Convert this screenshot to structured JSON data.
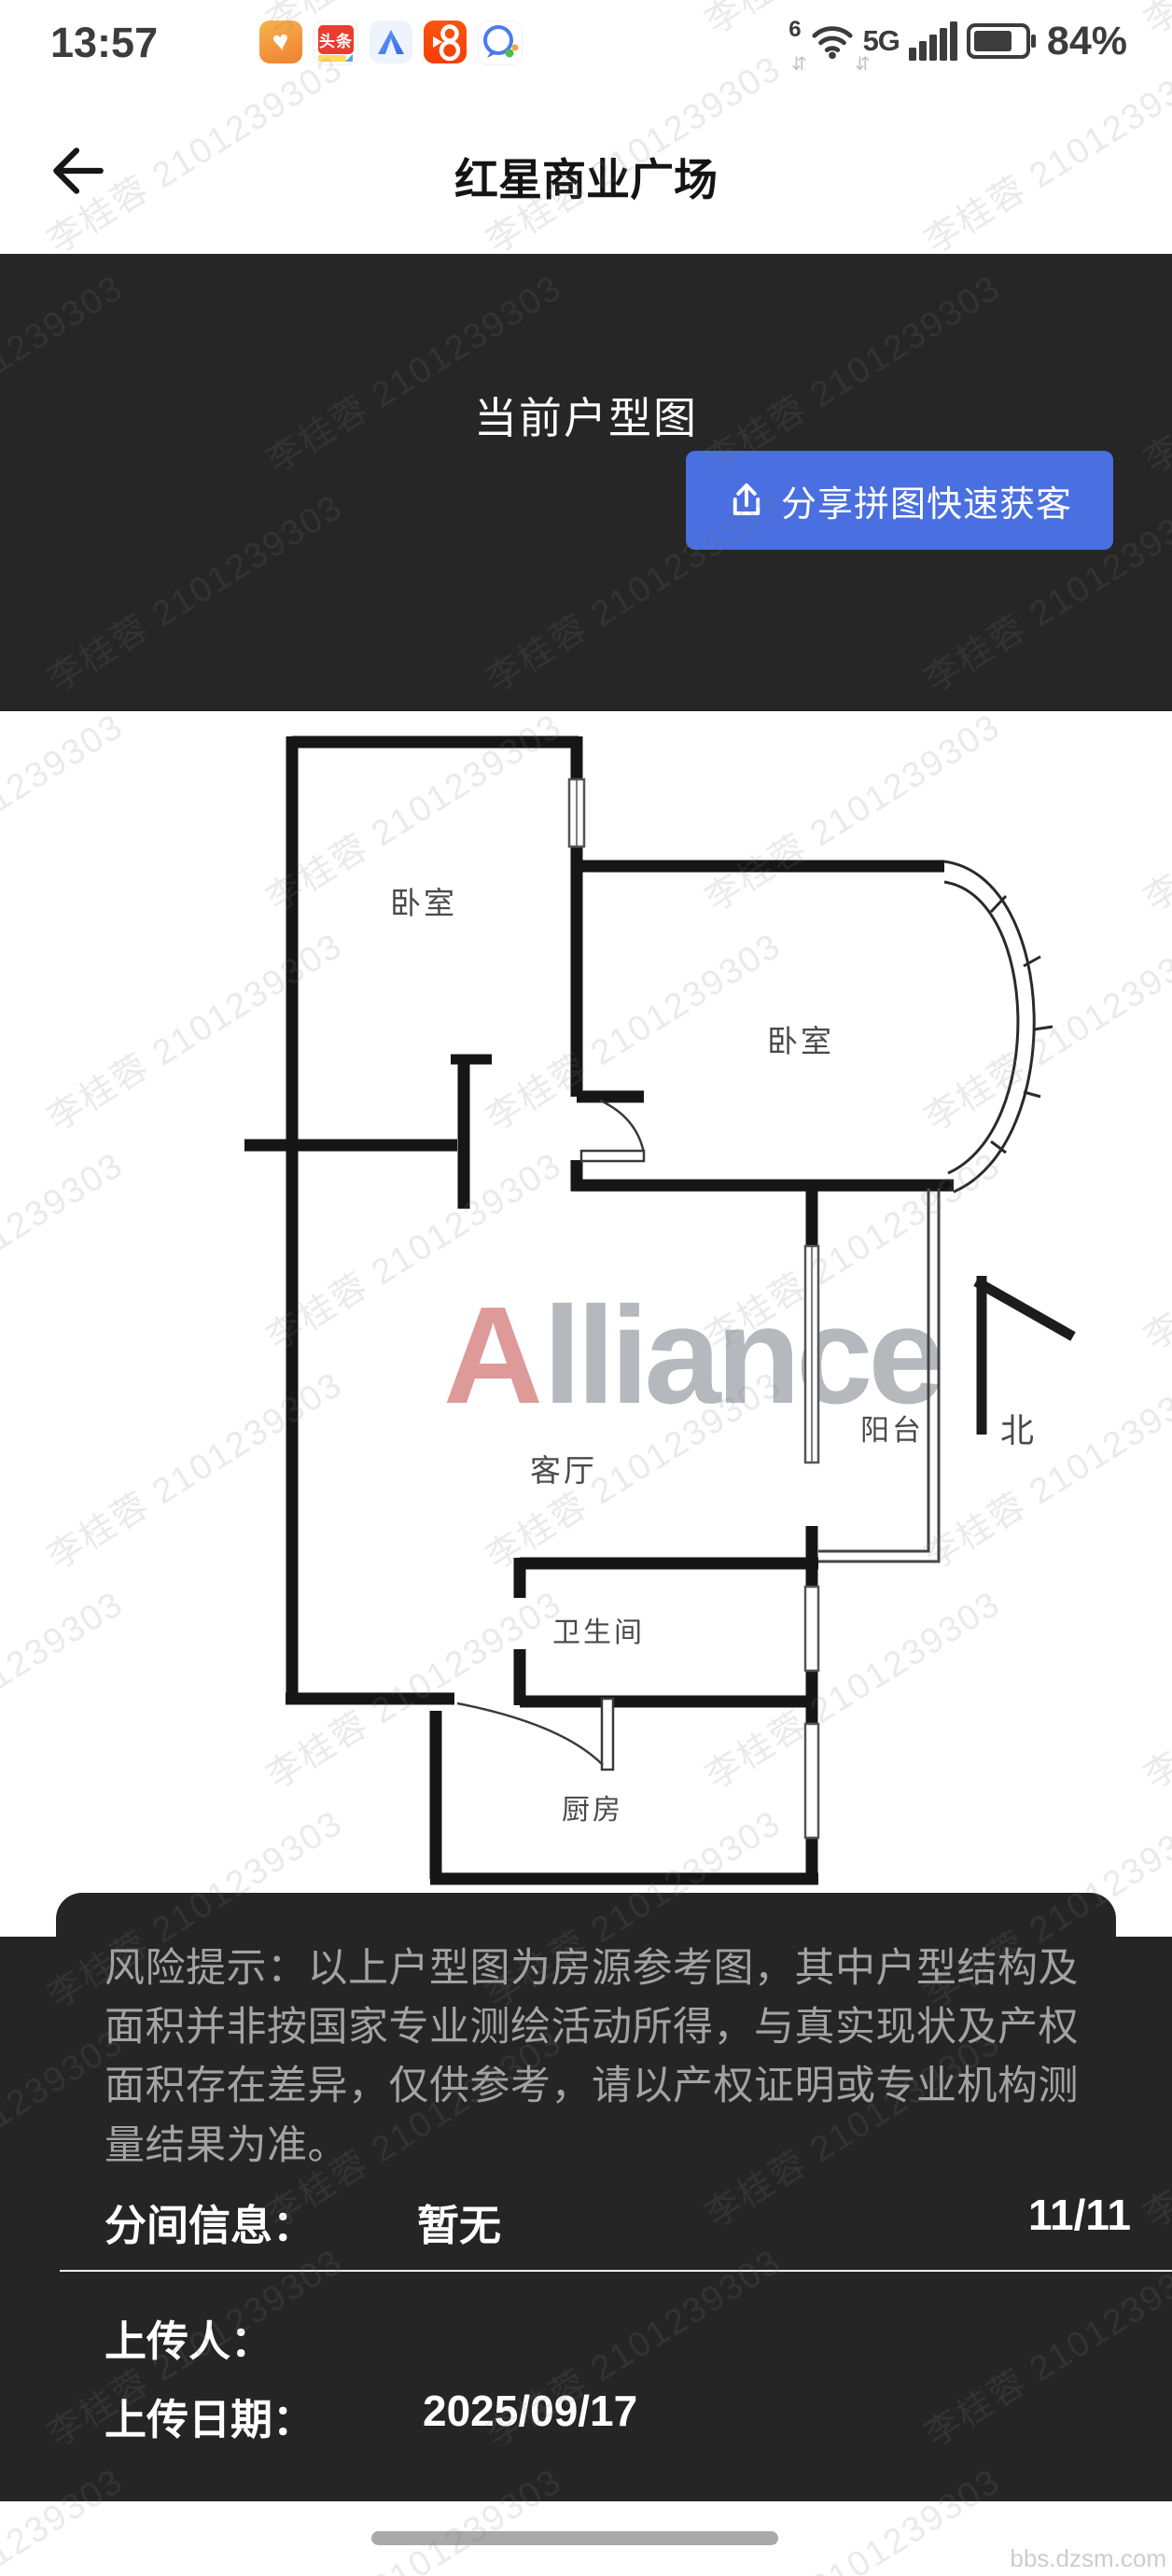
{
  "status_bar": {
    "time": "13:57",
    "wifi_generation": "6",
    "network": "5G",
    "battery_percent": "84%",
    "app_icons": [
      {
        "name": "heart-app-icon",
        "glyph": "♥"
      },
      {
        "name": "toutiao-app-icon",
        "label": "头条"
      },
      {
        "name": "a-app-icon"
      },
      {
        "name": "kuaishou-app-icon"
      },
      {
        "name": "chat-app-icon"
      }
    ]
  },
  "nav": {
    "title": "红星商业广场"
  },
  "header": {
    "title": "当前户型图",
    "share_button_label": "分享拼图快速获客"
  },
  "floorplan": {
    "brand_initial": "A",
    "brand_rest": "lliance",
    "north_label": "北",
    "rooms": {
      "bedroom_left": "卧室",
      "bedroom_right": "卧室",
      "living": "客厅",
      "balcony": "阳台",
      "bathroom": "卫生间",
      "kitchen": "厨房"
    }
  },
  "risk_notice": "风险提示：以上户型图为房源参考图，其中户型结构及面积并非按国家专业测绘活动所得，与真实现状及产权面积存在差异，仅供参考，请以产权证明或专业机构测量结果为准。",
  "info": {
    "partition_label": "分间信息：",
    "partition_value": "暂无",
    "page_indicator": "11/11",
    "uploader_label": "上传人：",
    "upload_date_label": "上传日期：",
    "upload_date": "2025/09/17"
  },
  "watermark_text": "李桂蓉 2101239303",
  "site_watermark": "bbs.dzsm.com",
  "colors": {
    "accent_blue": "#4a6fe0",
    "panel_dark": "#252525"
  }
}
